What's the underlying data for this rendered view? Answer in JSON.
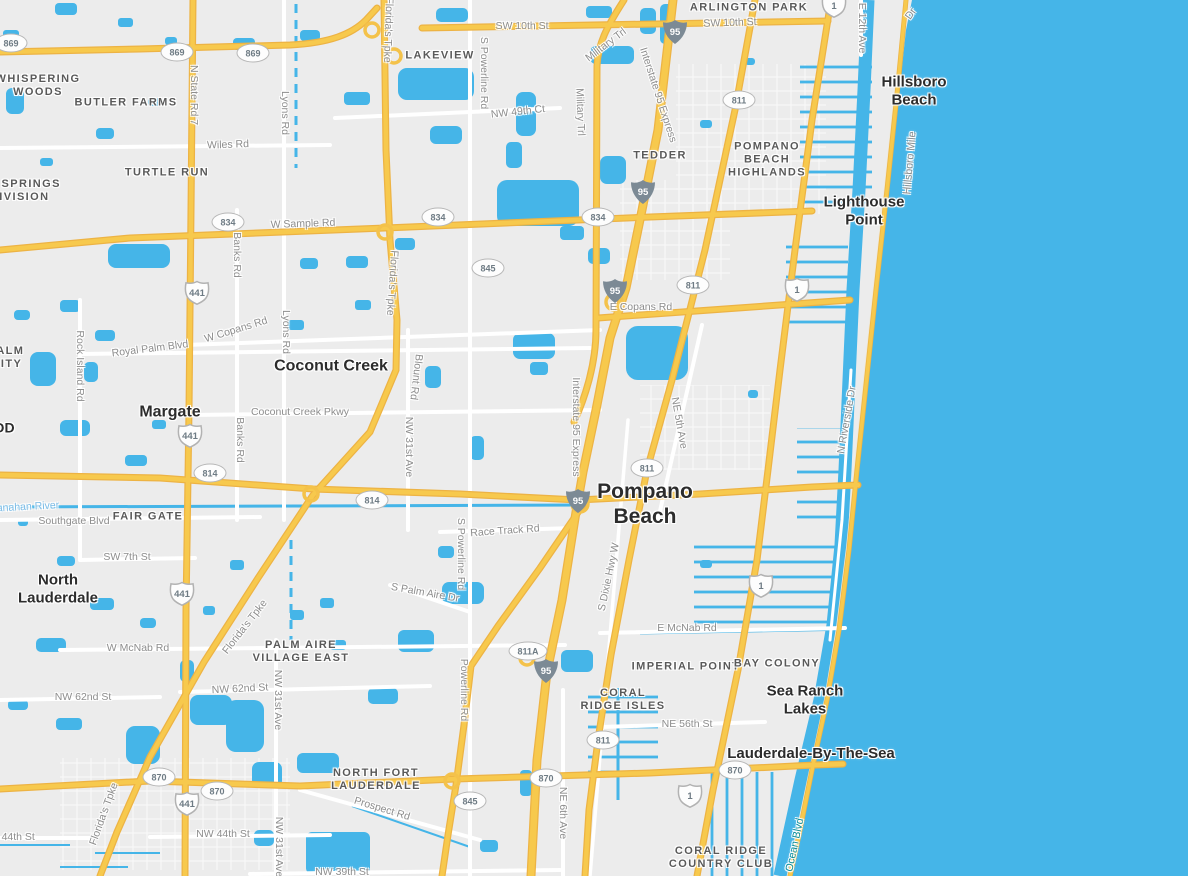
{
  "map": {
    "colors": {
      "ocean": "#45b5e8",
      "water": "#45b5e8",
      "land": "#ececec",
      "highway_fill": "#f7c94d",
      "highway_casing": "#edb344",
      "minor_road": "#ffffff",
      "sand": "#efe8d2",
      "interstate_shield": "#7c8a95",
      "city_label": "#2c2c2c",
      "neighborhood_label": "#595959",
      "road_label": "#8d8d8d",
      "water_label": "#7cbce6",
      "coastal_road_label": "#0b8f9b"
    },
    "place_labels": [
      {
        "kind": "city",
        "lines": [
          "Pompano",
          "Beach"
        ],
        "x": 645,
        "y": 505,
        "size": 21
      },
      {
        "kind": "city",
        "lines": [
          "Margate"
        ],
        "x": 170,
        "y": 413,
        "size": 16
      },
      {
        "kind": "city",
        "lines": [
          "Coconut Creek"
        ],
        "x": 331,
        "y": 367,
        "size": 16
      },
      {
        "kind": "city",
        "lines": [
          "North",
          "Lauderdale"
        ],
        "x": 58,
        "y": 589,
        "size": 15
      },
      {
        "kind": "city",
        "lines": [
          "Hillsboro",
          "Beach"
        ],
        "x": 914,
        "y": 91,
        "size": 15
      },
      {
        "kind": "city",
        "lines": [
          "Lighthouse",
          "Point"
        ],
        "x": 864,
        "y": 211,
        "size": 15
      },
      {
        "kind": "city",
        "lines": [
          "Sea Ranch",
          "Lakes"
        ],
        "x": 805,
        "y": 700,
        "size": 15
      },
      {
        "kind": "city",
        "lines": [
          "Lauderdale-By-The-Sea"
        ],
        "x": 811,
        "y": 754,
        "size": 15
      },
      {
        "kind": "city",
        "lines": [
          "WOOD"
        ],
        "x": -8,
        "y": 428,
        "size": 14
      },
      {
        "kind": "hood",
        "lines": [
          "WHISPERING",
          "WOODS"
        ],
        "x": 38,
        "y": 86,
        "size": 11
      },
      {
        "kind": "hood",
        "lines": [
          "BUTLER FARMS"
        ],
        "x": 126,
        "y": 103,
        "size": 11
      },
      {
        "kind": "hood",
        "lines": [
          "LAKEVIEW"
        ],
        "x": 440,
        "y": 56,
        "size": 11
      },
      {
        "kind": "hood",
        "lines": [
          "ARLINGTON PARK"
        ],
        "x": 749,
        "y": 8,
        "size": 11
      },
      {
        "kind": "hood",
        "lines": [
          "CORAL SPRINGS",
          "SUBDIVISION"
        ],
        "x": 6,
        "y": 191,
        "size": 11
      },
      {
        "kind": "hood",
        "lines": [
          "TURTLE RUN"
        ],
        "x": 167,
        "y": 173,
        "size": 11
      },
      {
        "kind": "hood",
        "lines": [
          "TEDDER"
        ],
        "x": 660,
        "y": 156,
        "size": 11
      },
      {
        "kind": "hood",
        "lines": [
          "POMPANO",
          "BEACH",
          "HIGHLANDS"
        ],
        "x": 767,
        "y": 160,
        "size": 11
      },
      {
        "kind": "hood",
        "lines": [
          "ROYAL PALM",
          "COMMUNITY"
        ],
        "x": -18,
        "y": 358,
        "size": 11
      },
      {
        "kind": "hood",
        "lines": [
          "FAIR GATE"
        ],
        "x": 148,
        "y": 517,
        "size": 11
      },
      {
        "kind": "hood",
        "lines": [
          "PALM AIRE",
          "VILLAGE EAST"
        ],
        "x": 301,
        "y": 652,
        "size": 11
      },
      {
        "kind": "hood",
        "lines": [
          "IMPERIAL POINT"
        ],
        "x": 686,
        "y": 667,
        "size": 11
      },
      {
        "kind": "hood",
        "lines": [
          "BAY COLONY"
        ],
        "x": 777,
        "y": 664,
        "size": 11
      },
      {
        "kind": "hood",
        "lines": [
          "CORAL",
          "RIDGE ISLES"
        ],
        "x": 623,
        "y": 700,
        "size": 11
      },
      {
        "kind": "hood",
        "lines": [
          "NORTH FORT",
          "LAUDERDALE"
        ],
        "x": 376,
        "y": 780,
        "size": 11
      },
      {
        "kind": "hood",
        "lines": [
          "CORAL RIDGE",
          "COUNTRY CLUB"
        ],
        "x": 721,
        "y": 858,
        "size": 11
      }
    ],
    "road_labels": [
      {
        "text": "SW 10th St",
        "x": 522,
        "y": 26,
        "rot": 0
      },
      {
        "text": "SW 10th St",
        "x": 730,
        "y": 23,
        "rot": -2
      },
      {
        "text": "NW 49th Ct",
        "x": 518,
        "y": 112,
        "rot": -6
      },
      {
        "text": "Wiles Rd",
        "x": 228,
        "y": 145,
        "rot": -2
      },
      {
        "text": "N State Rd 7",
        "x": 194,
        "y": 95,
        "rot": 90
      },
      {
        "text": "Lyons Rd",
        "x": 285,
        "y": 113,
        "rot": 90
      },
      {
        "text": "Lyons Rd",
        "x": 286,
        "y": 332,
        "rot": 90
      },
      {
        "text": "Florida's Tpke",
        "x": 388,
        "y": 30,
        "rot": 92
      },
      {
        "text": "Florida's Tpke",
        "x": 392,
        "y": 283,
        "rot": 94
      },
      {
        "text": "Florida's Tpke",
        "x": 245,
        "y": 627,
        "rot": -52
      },
      {
        "text": "Florida's Tpke",
        "x": 104,
        "y": 814,
        "rot": -70
      },
      {
        "text": "S Powerline Rd",
        "x": 484,
        "y": 73,
        "rot": 90
      },
      {
        "text": "S Powerline Rd",
        "x": 461,
        "y": 554,
        "rot": 90
      },
      {
        "text": "Powerline Rd",
        "x": 464,
        "y": 690,
        "rot": 90
      },
      {
        "text": "Military Trl",
        "x": 606,
        "y": 45,
        "rot": -37
      },
      {
        "text": "Military Trl",
        "x": 580,
        "y": 112,
        "rot": 88
      },
      {
        "text": "Interstate 95 Express",
        "x": 658,
        "y": 95,
        "rot": 72
      },
      {
        "text": "Interstate 95 Express",
        "x": 576,
        "y": 427,
        "rot": 90
      },
      {
        "text": "W Sample Rd",
        "x": 303,
        "y": 224,
        "rot": -2
      },
      {
        "text": "Banks Rd",
        "x": 237,
        "y": 255,
        "rot": 90
      },
      {
        "text": "Banks Rd",
        "x": 240,
        "y": 440,
        "rot": 90
      },
      {
        "text": "W Copans Rd",
        "x": 236,
        "y": 330,
        "rot": -17
      },
      {
        "text": "E Copans Rd",
        "x": 641,
        "y": 307,
        "rot": 0
      },
      {
        "text": "Royal Palm Blvd",
        "x": 150,
        "y": 349,
        "rot": -7
      },
      {
        "text": "Rock Island Rd",
        "x": 80,
        "y": 366,
        "rot": 90
      },
      {
        "text": "Coconut Creek Pkwy",
        "x": 300,
        "y": 412,
        "rot": 0
      },
      {
        "text": "Blount Rd",
        "x": 416,
        "y": 377,
        "rot": 97
      },
      {
        "text": "NW 31st Ave",
        "x": 409,
        "y": 447,
        "rot": 90
      },
      {
        "text": "NE 5th Ave",
        "x": 679,
        "y": 423,
        "rot": 80
      },
      {
        "text": "Race Track Rd",
        "x": 505,
        "y": 531,
        "rot": -4
      },
      {
        "text": "S Palm Aire Dr",
        "x": 425,
        "y": 593,
        "rot": 10
      },
      {
        "text": "Southgate Blvd",
        "x": 74,
        "y": 521,
        "rot": 0
      },
      {
        "text": "SW 7th St",
        "x": 127,
        "y": 557,
        "rot": 0
      },
      {
        "text": "W McNab Rd",
        "x": 138,
        "y": 648,
        "rot": 0
      },
      {
        "text": "E McNab Rd",
        "x": 687,
        "y": 628,
        "rot": 0
      },
      {
        "text": "NW 62nd St",
        "x": 83,
        "y": 697,
        "rot": 0
      },
      {
        "text": "NW 62nd St",
        "x": 240,
        "y": 689,
        "rot": -3
      },
      {
        "text": "NW 31st Ave",
        "x": 278,
        "y": 700,
        "rot": 90
      },
      {
        "text": "NW 31st Ave",
        "x": 279,
        "y": 847,
        "rot": 90
      },
      {
        "text": "NW 44th St",
        "x": 8,
        "y": 837,
        "rot": 0
      },
      {
        "text": "NW 44th St",
        "x": 223,
        "y": 834,
        "rot": 0
      },
      {
        "text": "NW 39th St",
        "x": 342,
        "y": 872,
        "rot": 0
      },
      {
        "text": "Prospect Rd",
        "x": 382,
        "y": 809,
        "rot": 17
      },
      {
        "text": "NE 6th Ave",
        "x": 563,
        "y": 813,
        "rot": 90
      },
      {
        "text": "NE 56th St",
        "x": 687,
        "y": 724,
        "rot": 0
      },
      {
        "text": "S Dixie Hwy W",
        "x": 609,
        "y": 577,
        "rot": -78
      },
      {
        "text": "E 12th Ave",
        "x": 862,
        "y": 28,
        "rot": 90
      },
      {
        "text": "Dr",
        "x": 911,
        "y": 14,
        "rot": -55
      },
      {
        "text": "Hillsboro Mile",
        "x": 910,
        "y": 163,
        "rot": -85
      },
      {
        "text": "N Riverside Dr",
        "x": 847,
        "y": 420,
        "rot": -80
      },
      {
        "text": "Ocean Blvd",
        "x": 795,
        "y": 845,
        "rot": -78,
        "style": "teal"
      },
      {
        "text": "anahan River",
        "x": 28,
        "y": 507,
        "rot": -3,
        "style": "water"
      }
    ],
    "shields": [
      {
        "type": "oval",
        "text": "869",
        "x": 11,
        "y": 43
      },
      {
        "type": "oval",
        "text": "869",
        "x": 177,
        "y": 52
      },
      {
        "type": "oval",
        "text": "869",
        "x": 253,
        "y": 53
      },
      {
        "type": "oval",
        "text": "834",
        "x": 228,
        "y": 222
      },
      {
        "type": "oval",
        "text": "834",
        "x": 438,
        "y": 217
      },
      {
        "type": "oval",
        "text": "834",
        "x": 598,
        "y": 217
      },
      {
        "type": "oval",
        "text": "845",
        "x": 488,
        "y": 268
      },
      {
        "type": "oval",
        "text": "845",
        "x": 470,
        "y": 801
      },
      {
        "type": "oval",
        "text": "811",
        "x": 739,
        "y": 100
      },
      {
        "type": "oval",
        "text": "811",
        "x": 693,
        "y": 285
      },
      {
        "type": "oval",
        "text": "811",
        "x": 647,
        "y": 468
      },
      {
        "type": "oval",
        "text": "811",
        "x": 603,
        "y": 740
      },
      {
        "type": "oval",
        "text": "811A",
        "x": 528,
        "y": 651
      },
      {
        "type": "oval",
        "text": "814",
        "x": 210,
        "y": 473
      },
      {
        "type": "oval",
        "text": "814",
        "x": 372,
        "y": 500
      },
      {
        "type": "oval",
        "text": "870",
        "x": 159,
        "y": 777
      },
      {
        "type": "oval",
        "text": "870",
        "x": 217,
        "y": 791
      },
      {
        "type": "oval",
        "text": "870",
        "x": 546,
        "y": 778
      },
      {
        "type": "oval",
        "text": "870",
        "x": 735,
        "y": 770
      },
      {
        "type": "us",
        "text": "441",
        "x": 197,
        "y": 293
      },
      {
        "type": "us",
        "text": "441",
        "x": 190,
        "y": 436
      },
      {
        "type": "us",
        "text": "441",
        "x": 182,
        "y": 594
      },
      {
        "type": "us",
        "text": "441",
        "x": 187,
        "y": 804
      },
      {
        "type": "us",
        "text": "1",
        "x": 834,
        "y": 6
      },
      {
        "type": "us",
        "text": "1",
        "x": 797,
        "y": 290
      },
      {
        "type": "us",
        "text": "1",
        "x": 761,
        "y": 586
      },
      {
        "type": "us",
        "text": "1",
        "x": 690,
        "y": 796
      },
      {
        "type": "interstate",
        "text": "95",
        "x": 675,
        "y": 32
      },
      {
        "type": "interstate",
        "text": "95",
        "x": 643,
        "y": 192
      },
      {
        "type": "interstate",
        "text": "95",
        "x": 615,
        "y": 291
      },
      {
        "type": "interstate",
        "text": "95",
        "x": 578,
        "y": 501
      },
      {
        "type": "interstate",
        "text": "95",
        "x": 546,
        "y": 671
      }
    ]
  }
}
